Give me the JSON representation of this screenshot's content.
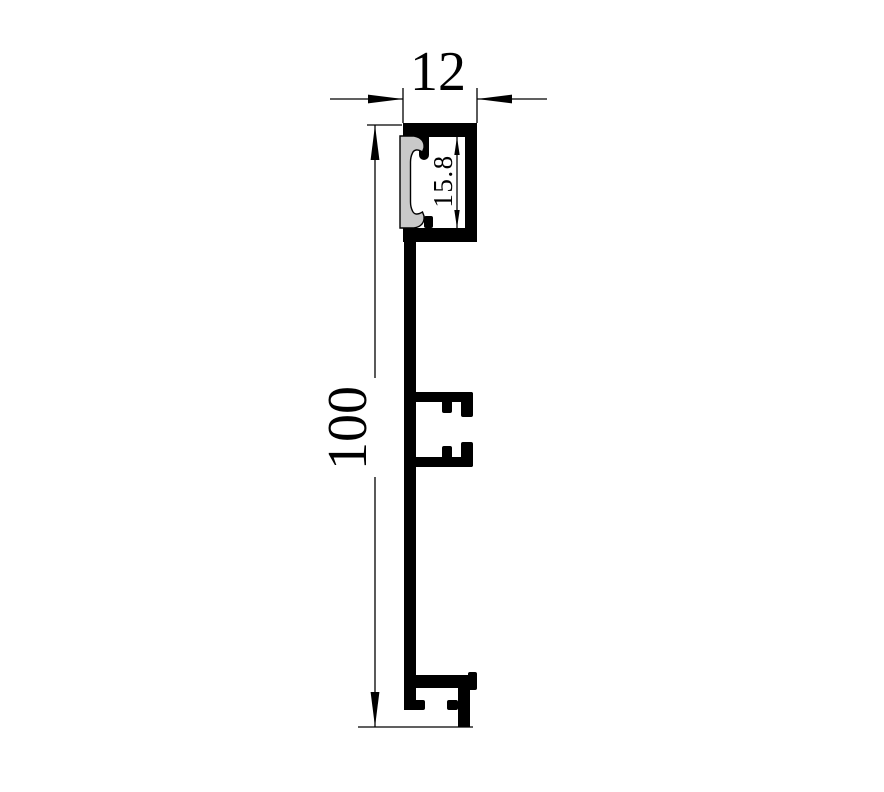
{
  "page": {
    "background_color": "#ffffff"
  },
  "drawing": {
    "description": "Technical cross-section drawing of an aluminium skirting profile with LED diffuser channel at top, a central clip slot and a bottom mounting foot",
    "ink_color": "#000000",
    "cover_fill_color": "#c9c9c9",
    "dimensions": {
      "overall_width": "12",
      "overall_height": "100",
      "channel_inner_height": "15.8"
    }
  }
}
